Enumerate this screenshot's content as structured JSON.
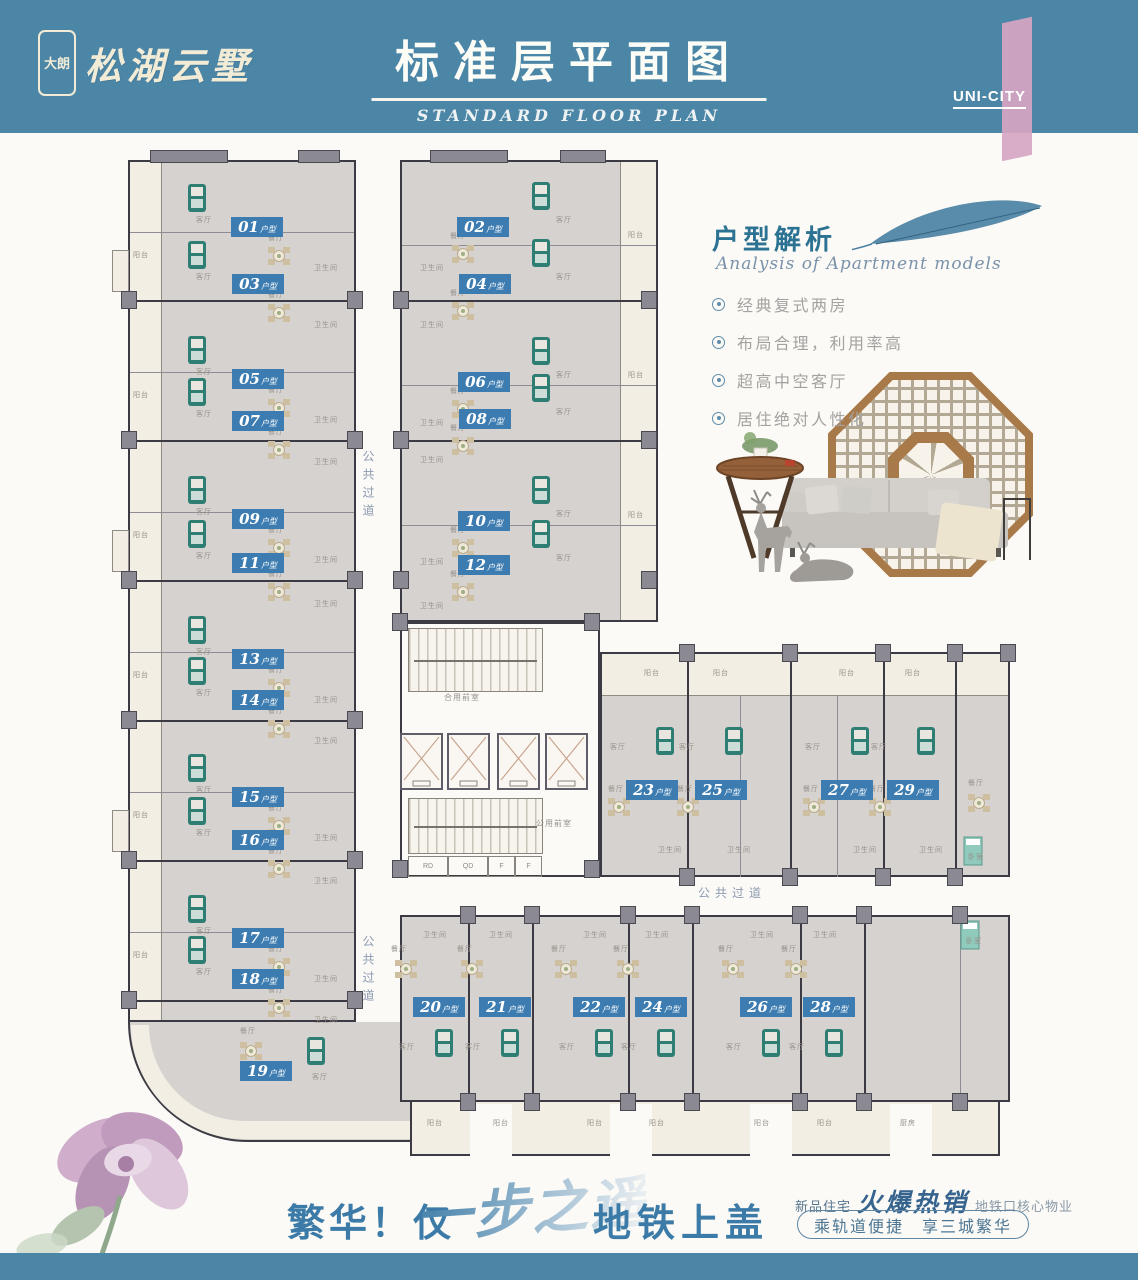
{
  "header": {
    "logo_badge": "大朗",
    "logo_name": "松湖云墅",
    "title": "标准层平面图",
    "subtitle": "STANDARD FLOOR PLAN",
    "brand": "UNI-CITY"
  },
  "analysis": {
    "title": "户型解析",
    "subtitle": "Analysis of Apartment models",
    "bullets": [
      "经典复式两房",
      "布局合理，利用率高",
      "超高中空客厅",
      "居住绝对人性化"
    ]
  },
  "plan": {
    "unit_suffix": "户型",
    "corridor": "公共过道",
    "rooms": {
      "dining": "餐厅",
      "living": "客厅",
      "bath": "卫生间",
      "kitchen": "厨房",
      "balcony": "阳台",
      "bedroom": "卧室"
    },
    "core": {
      "upper_lobby": "合用前室",
      "lower_lobby": "公用前室",
      "small_rooms": [
        "RD",
        "QD",
        "F",
        "F"
      ]
    },
    "units_left_west": [
      "01",
      "03",
      "05",
      "07",
      "09",
      "11",
      "13",
      "14",
      "15",
      "16",
      "17",
      "18",
      "19"
    ],
    "units_left_east": [
      "02",
      "04",
      "06",
      "08",
      "10",
      "12"
    ],
    "units_right_north": [
      "23",
      "25",
      "27",
      "29"
    ],
    "units_right_south": [
      "20",
      "21",
      "22",
      "24",
      "26",
      "28"
    ]
  },
  "marketing": {
    "left_1": "繁华！仅",
    "left_script": "一步之遥",
    "left_2": "地铁上盖",
    "right_prefix": "新品住宅",
    "right_script": "火爆热销",
    "right_suffix": "地铁口核心物业",
    "pill_left": "乘轨道便捷",
    "pill_right": "享三城繁华"
  },
  "colors": {
    "header_blue": "#4C86A7",
    "badge_blue": "#3D7CB0",
    "accent_pink": "#D6A6C3",
    "analysis_teal": "#2C7292",
    "floor_gray": "#D6D2CF",
    "balcony_cream": "#F3EEE3",
    "wall_dark": "#3C3B43"
  }
}
